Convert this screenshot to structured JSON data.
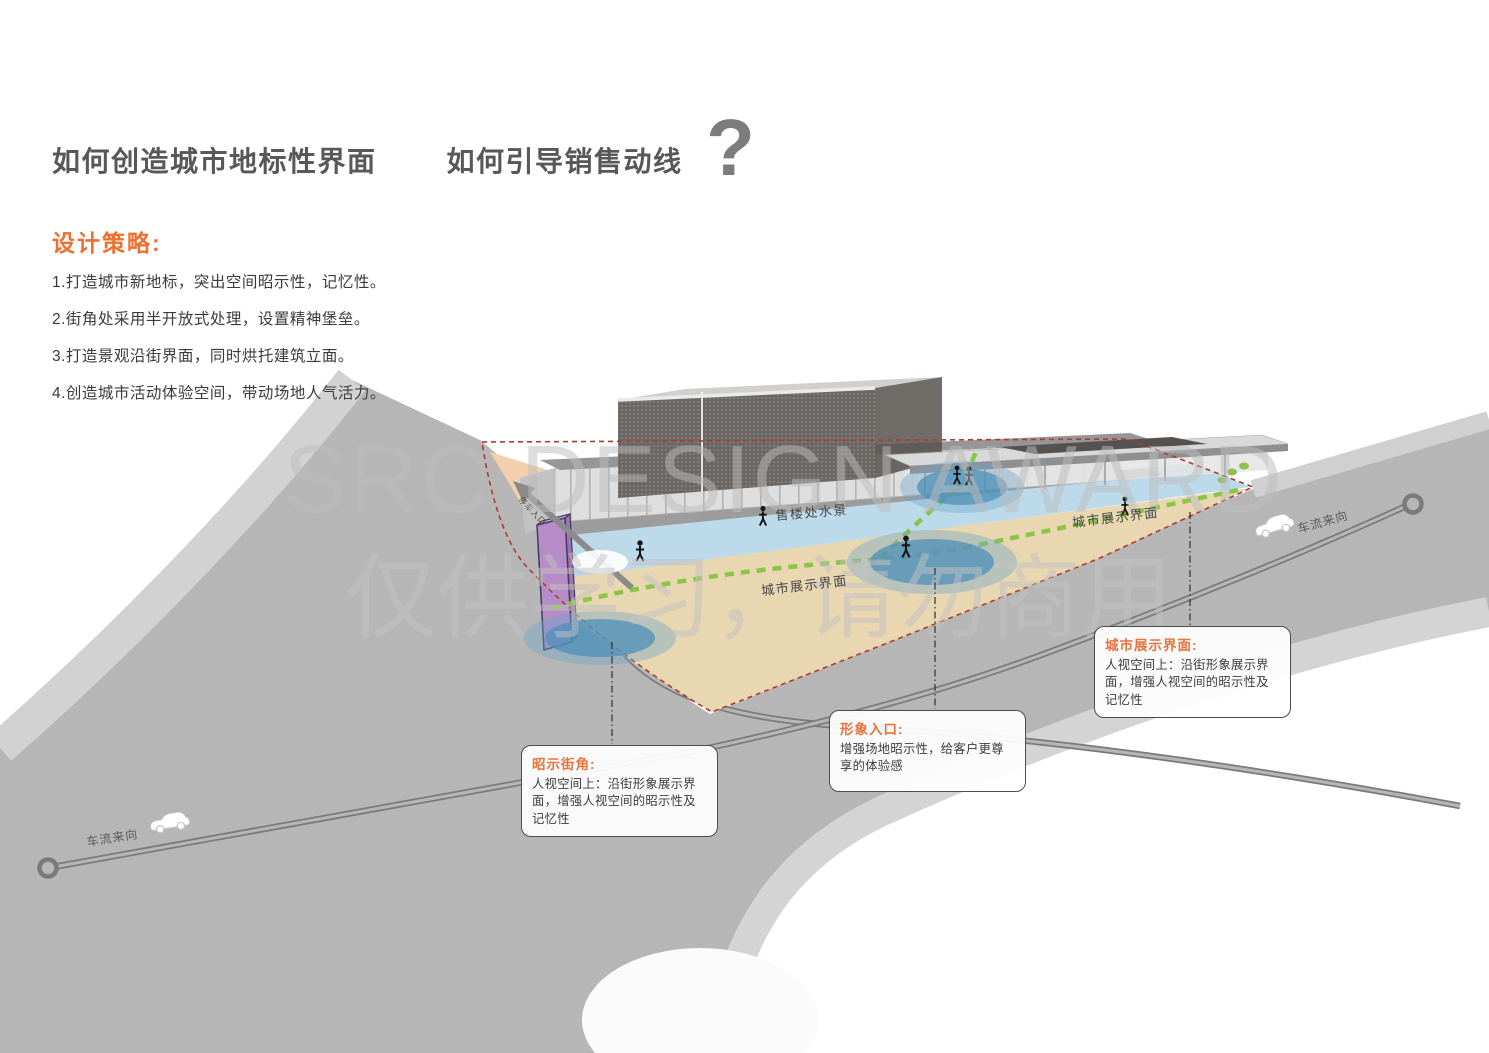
{
  "header": {
    "title_left": "如何创造城市地标性界面",
    "title_right": "如何引导销售动线",
    "question_mark": "?"
  },
  "strategy": {
    "heading": "设计策略:",
    "items": [
      "1.打造城市新地标，突出空间昭示性，记忆性。",
      "2.街角处采用半开放式处理，设置精神堡垒。",
      "3.打造景观沿街界面，同时烘托建筑立面。",
      "4.创造城市活动体验空间，带动场地人气活力。"
    ]
  },
  "watermark": {
    "line1": "SRC DESIGN AWARD",
    "line2": "仅供学习，请勿商用"
  },
  "diagram": {
    "water_label": "售楼处水景",
    "display_interface_label_left": "城市展示界面",
    "display_interface_label_right": "城市展示界面",
    "traffic_label_left": "车流来向",
    "traffic_label_right": "车流来向",
    "entrance_label": "停车入口",
    "callouts": [
      {
        "title": "昭示街角:",
        "body": "人视空间上：沿街形象展示界面，增强人视空间的昭示性及记忆性"
      },
      {
        "title": "形象入口:",
        "body": "增强场地昭示性，给客户更尊享的体验感"
      },
      {
        "title": "城市展示界面:",
        "body": "人视空间上：沿街形象展示界面，增强人视空间的昭示性及记忆性"
      }
    ]
  },
  "colors": {
    "accent_orange": "#EC7030",
    "title_gray": "#595757",
    "road_gray": "#B6B6B6",
    "site_tan": "#E8D7B1",
    "water_blue": "#B9D8EA",
    "path_green": "#85C440",
    "boundary_red": "#B03A30",
    "tower_purple": "#B58CC6"
  }
}
